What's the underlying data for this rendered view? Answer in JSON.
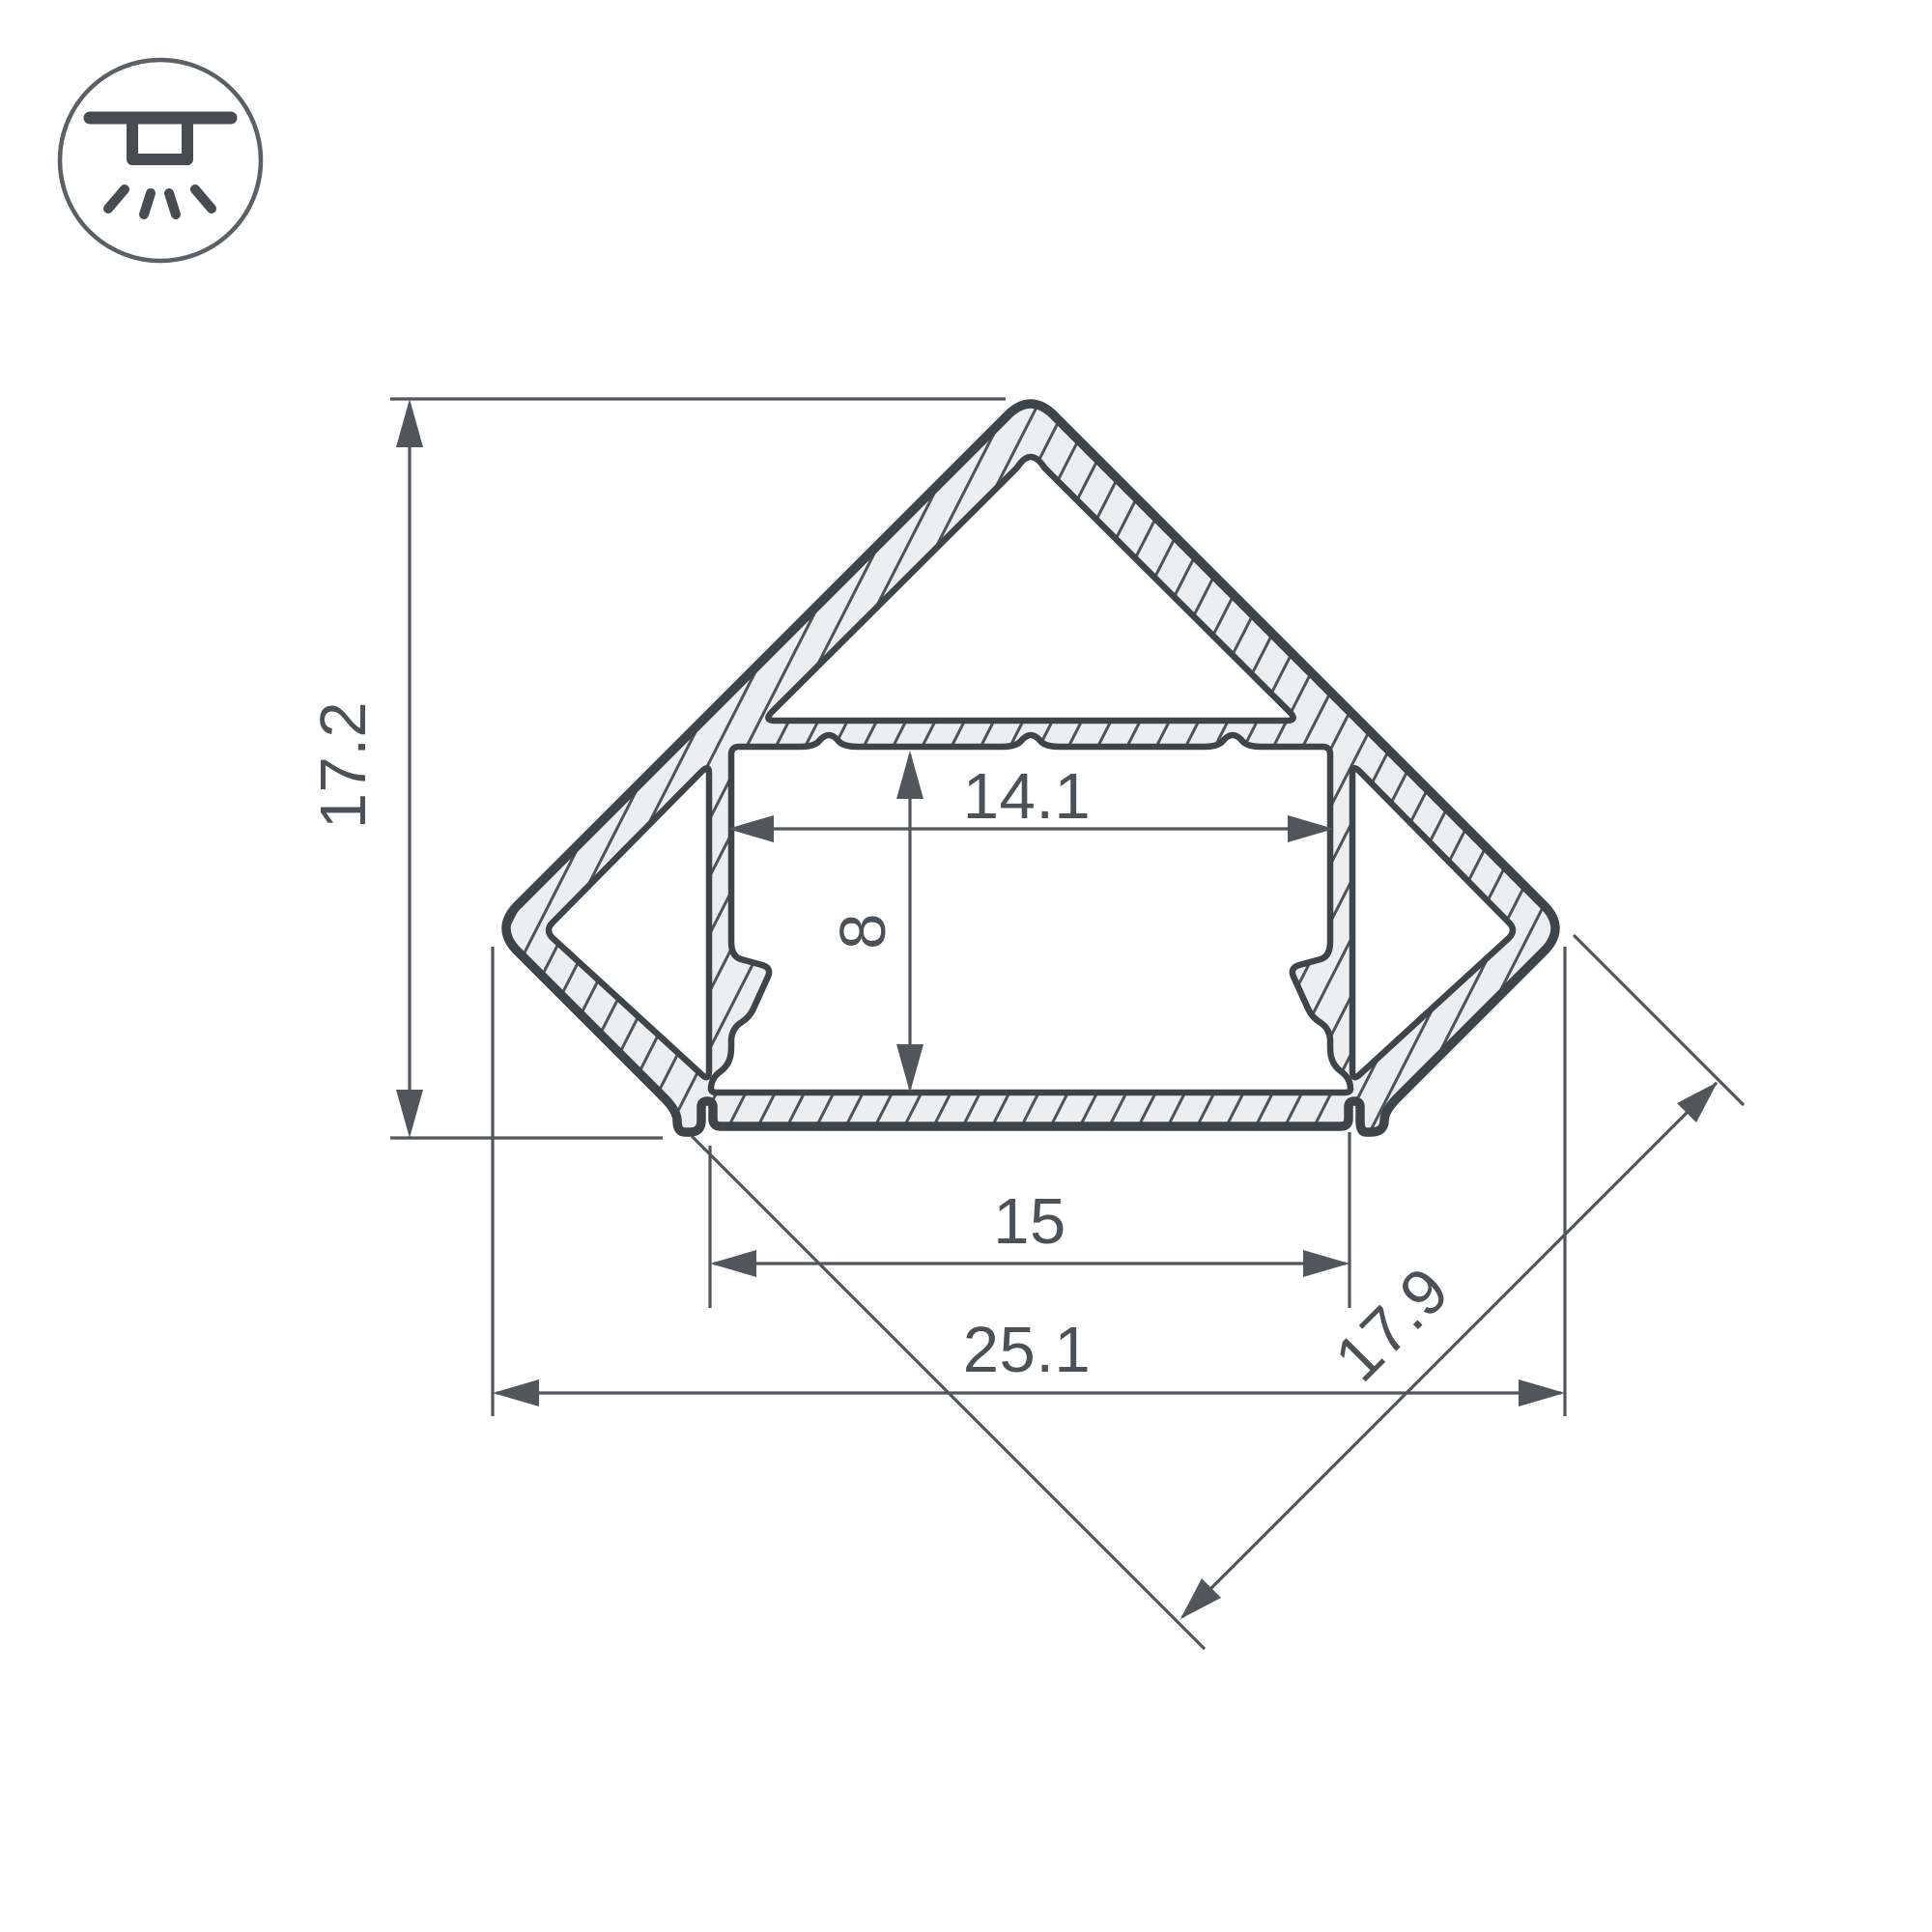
{
  "page": {
    "background": "#ffffff"
  },
  "icon": {
    "name": "recessed-ceiling-light",
    "style": "circle-badge"
  },
  "drawing": {
    "type": "technical-cross-section",
    "subject": "45-degree corner LED aluminum profile",
    "dimensions": {
      "overall_height": "17.2",
      "channel_inner_width": "14.1",
      "channel_inner_height": "8",
      "bottom_width": "15",
      "overall_width": "25.1",
      "side_width": "17.9"
    },
    "colors": {
      "outline": "#3d444a",
      "dimension": "#50565c",
      "metal_fill": "#edeef0",
      "hatch": "#4c5359",
      "background": "#ffffff"
    }
  }
}
